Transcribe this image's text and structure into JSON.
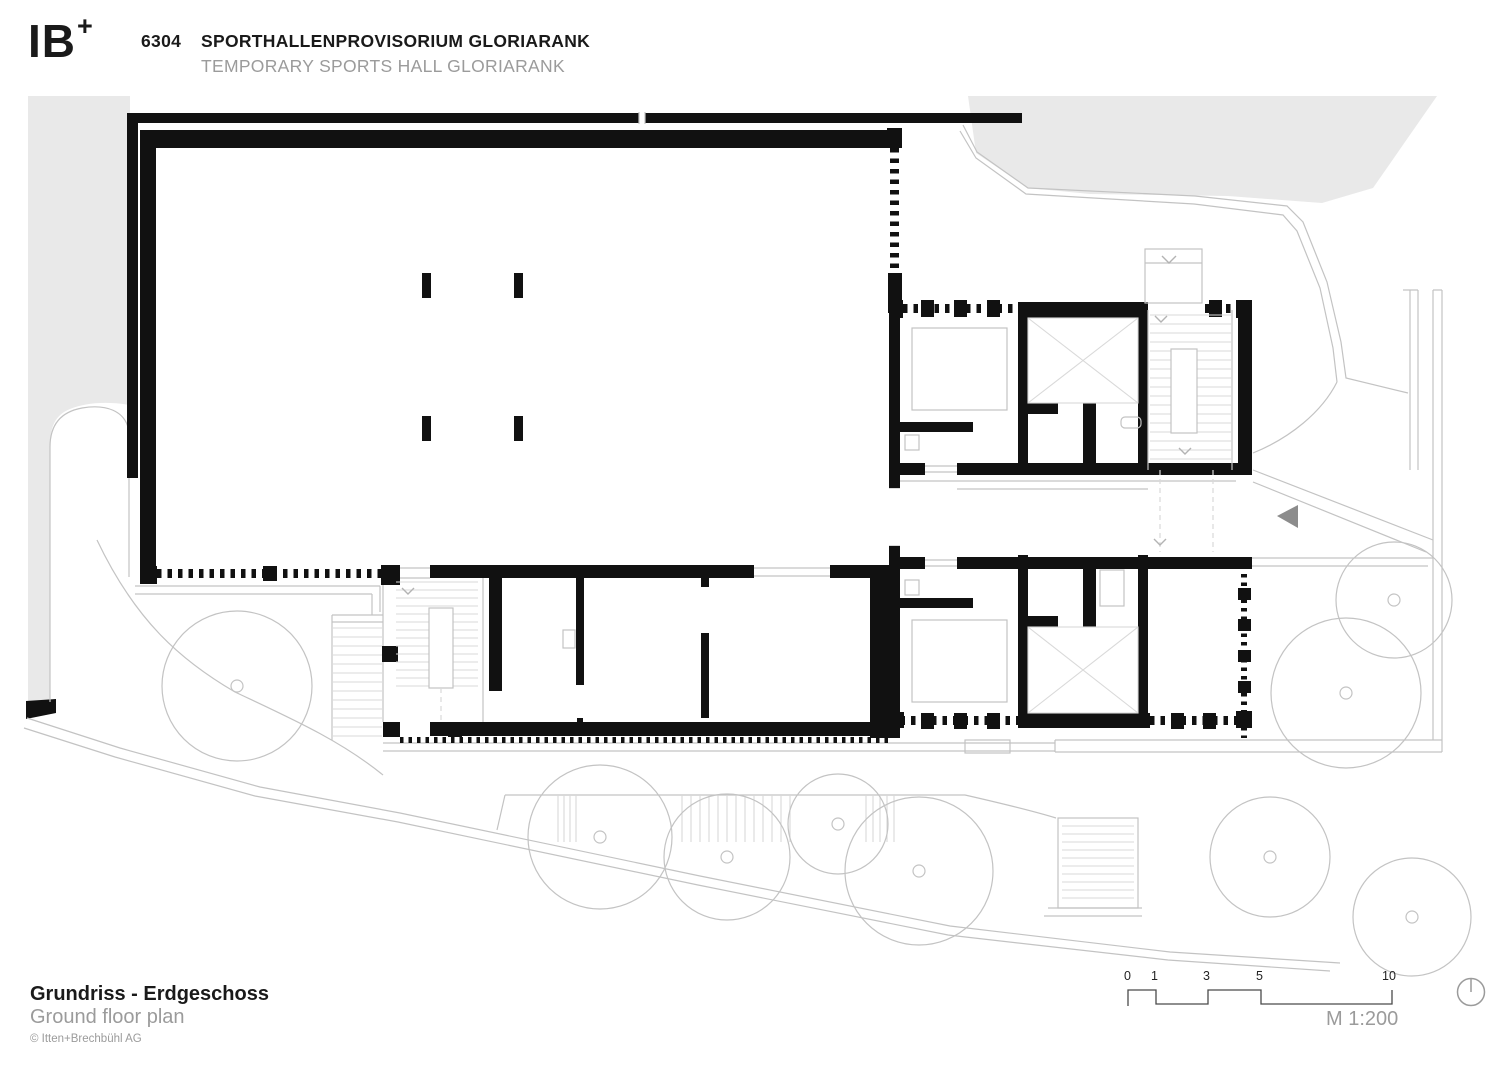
{
  "header": {
    "logo_text": "IB",
    "logo_plus": "+",
    "project_number": "6304",
    "title_de": "SPORTHALLENPROVISORIUM GLORIARANK",
    "title_en": "TEMPORARY SPORTS HALL GLORIARANK"
  },
  "footer": {
    "title_de": "Grundriss - Erdgeschoss",
    "title_en": "Ground floor plan",
    "copyright": "© Itten+Brechbühl AG"
  },
  "scale_bar": {
    "labels": [
      "0",
      "1",
      "3",
      "5",
      "10"
    ],
    "ratio_label": "M 1:200"
  },
  "icons": {
    "north_indicator": "north-circle-icon",
    "entrance_arrow": "triangle-left-icon"
  },
  "colors": {
    "wall": "#111111",
    "site_fill": "#e9e9e9",
    "thin_line": "#c3c3c3",
    "faint_line": "#d9d9d9",
    "muted_text": "#9b9b9b",
    "text": "#1a1a1a",
    "arrow": "#8c8c8c",
    "scale_line": "#4a4a4a"
  }
}
